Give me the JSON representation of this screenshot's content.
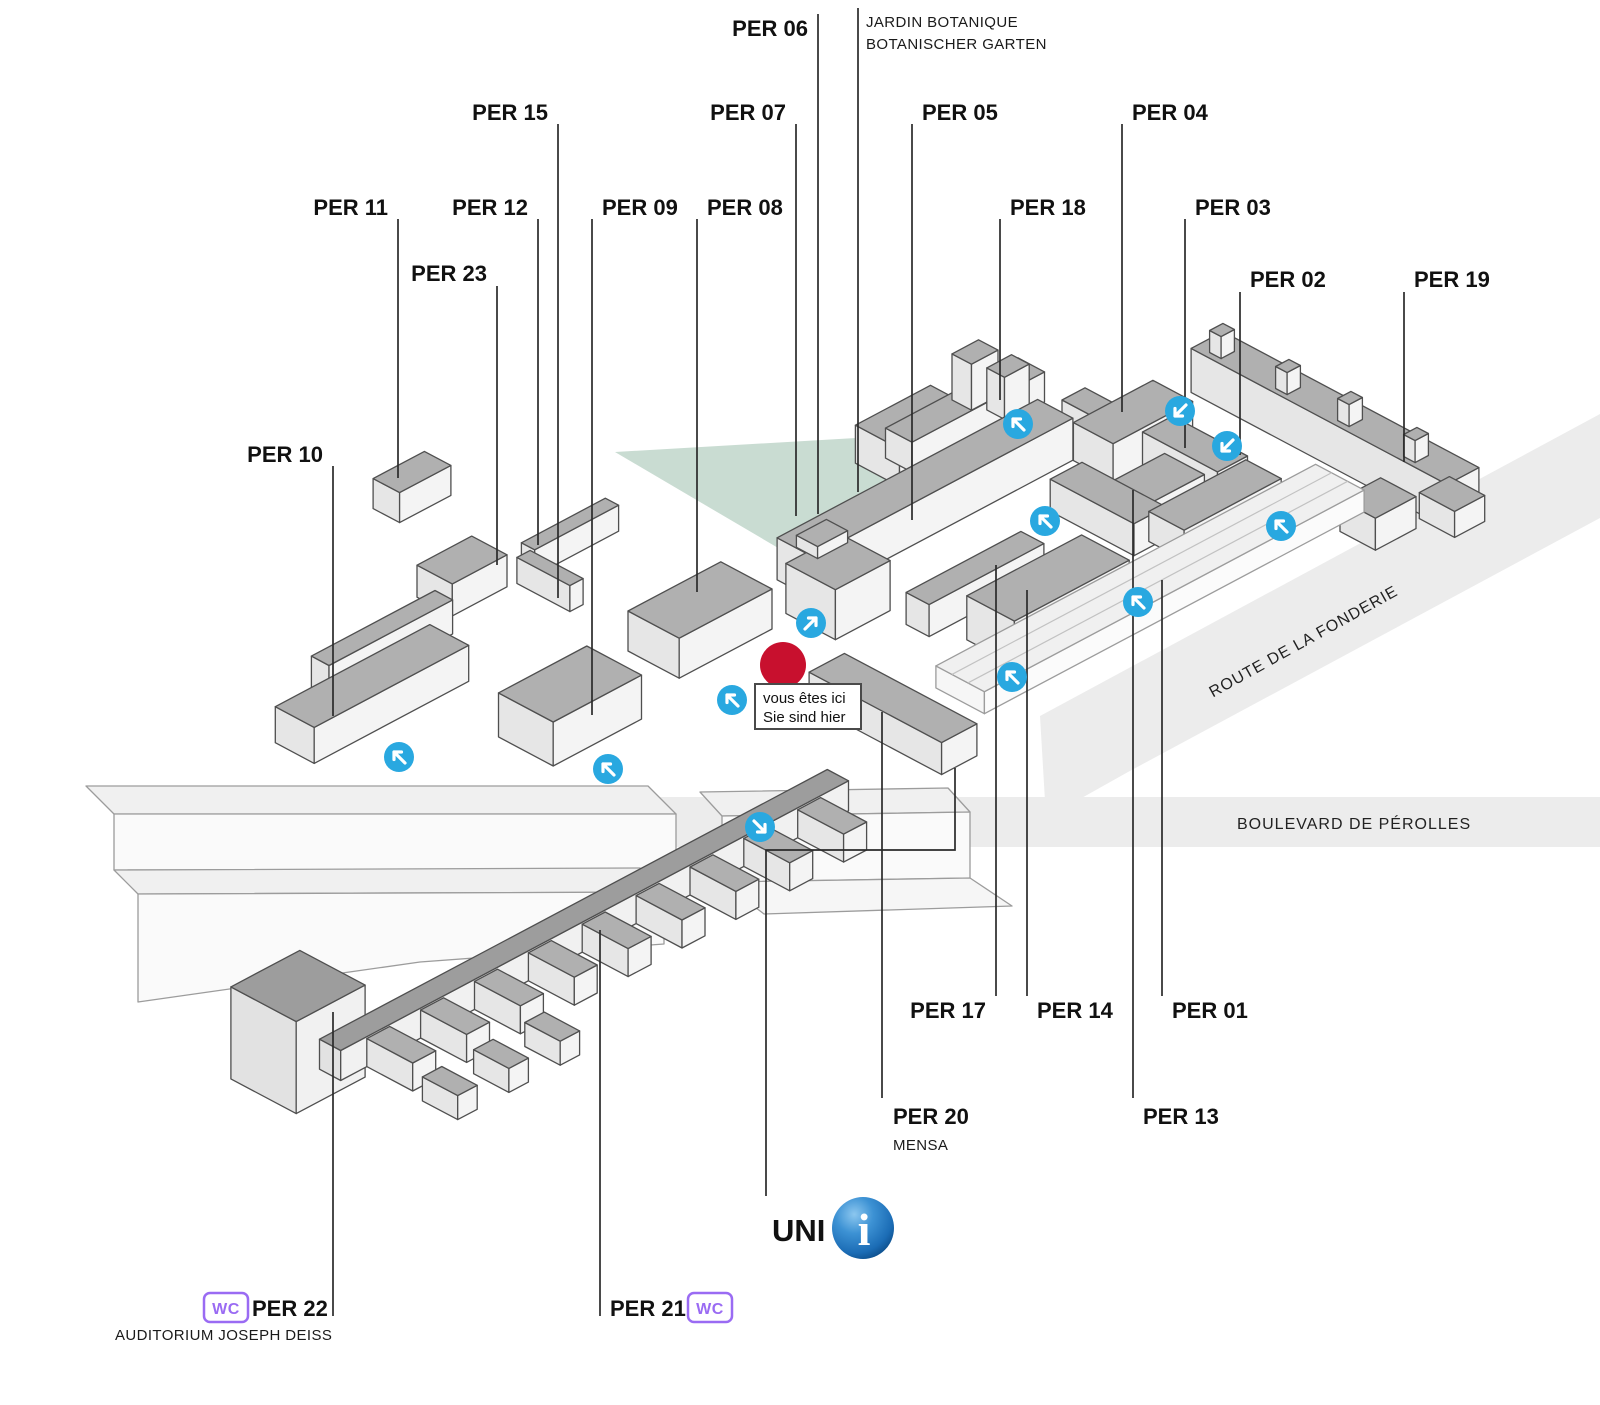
{
  "labels": {
    "per01": "PER 01",
    "per02": "PER 02",
    "per03": "PER 03",
    "per04": "PER 04",
    "per05": "PER 05",
    "per06": "PER 06",
    "per07": "PER 07",
    "per08": "PER 08",
    "per09": "PER 09",
    "per10": "PER 10",
    "per11": "PER 11",
    "per12": "PER 12",
    "per13": "PER 13",
    "per14": "PER 14",
    "per15": "PER 15",
    "per17": "PER 17",
    "per18": "PER 18",
    "per19": "PER 19",
    "per20": "PER 20",
    "per21": "PER 21",
    "per22": "PER 22",
    "per23": "PER 23"
  },
  "annotations": {
    "jardin_line1": "JARDIN BOTANIQUE",
    "jardin_line2": "BOTANISCHER GARTEN",
    "mensa": "MENSA",
    "auditorium": "AUDITORIUM JOSEPH DEISS",
    "you_are_here_fr": "vous êtes ici",
    "you_are_here_de": "Sie sind hier",
    "uni": "UNI",
    "info_letter": "i",
    "wc": "WC"
  },
  "streets": {
    "fonderie": "ROUTE DE LA FONDERIE",
    "boulevard": "BOULEVARD DE PÉROLLES"
  },
  "colors": {
    "entrance_blue": "#29a8e0",
    "marker_red": "#c8102e",
    "garden_green": "#c9dcd2",
    "street_gray": "#ececec",
    "wc_purple": "#9a6bf3",
    "uni_sphere_blue": "#1b6cb5",
    "label_black": "#111111"
  }
}
